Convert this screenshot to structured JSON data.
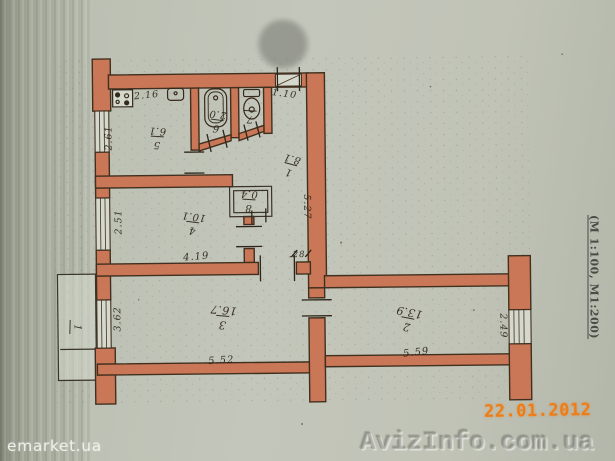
{
  "photo": {
    "scale_note": "(М 1:100, М1:200)",
    "date_stamp": "22.01.2012",
    "watermark_left": "emarket.ua",
    "watermark_right": "AvizInfo.com.ua"
  },
  "floor_plan": {
    "rooms": [
      {
        "name": "hallway",
        "number": "1",
        "area": "8.1"
      },
      {
        "name": "living-room",
        "number": "2",
        "area": "13.9"
      },
      {
        "name": "living-room",
        "number": "3",
        "area": "16.7"
      },
      {
        "name": "bedroom",
        "number": "4",
        "area": "10.1"
      },
      {
        "name": "kitchen",
        "number": "5",
        "area": "6.1"
      },
      {
        "name": "bathroom",
        "number": "6",
        "area": "2.0"
      },
      {
        "name": "wc",
        "number": "7",
        "area": ""
      },
      {
        "name": "closet",
        "number": "8",
        "area": "0.4"
      },
      {
        "name": "balcony",
        "number": "1",
        "area": ""
      }
    ],
    "dimensions": {
      "kitchen_width": "2.16",
      "kitchen_depth": "2.61",
      "entry_width": "1.10",
      "hall_length": "5.27",
      "room4_depth": "2.51",
      "room4_width": "4.19",
      "wall_offset": ".28",
      "room3_depth": "3.62",
      "room3_width": "5.52",
      "room2_width": "5.59",
      "room2_depth": "2.49"
    }
  }
}
